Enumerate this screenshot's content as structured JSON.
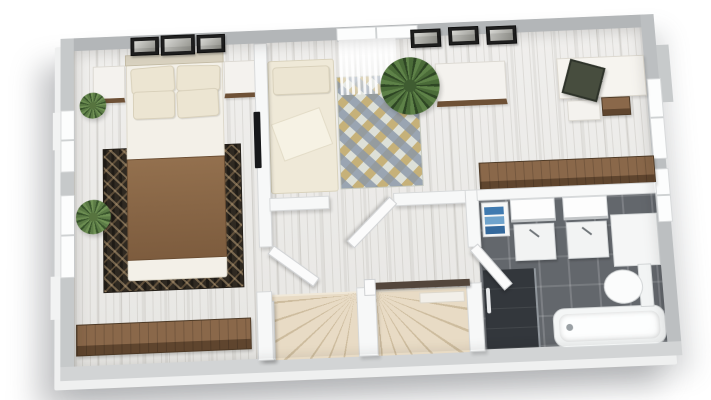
{
  "scene": {
    "view": "3d-floor-plan-render",
    "background": "#ffffff",
    "floor_style": "whitewashed-wood-planks",
    "bathroom_floor_style": "dark-gray-tile"
  },
  "palette": {
    "exterior_wall_cut": "#b6b9bb",
    "exterior_wall_light": "#d2d4d5",
    "interior_wall": "#f7f8f8",
    "wood_floor": "#edecea",
    "tile_floor": "#63676c",
    "shower_tile": "#33373c",
    "stair_tread": "#e8dbc5",
    "handrail": "#53463c",
    "rug_dark_base": "#2f2921",
    "rug_dark_accent": "#c4a880",
    "rug_diamond_base": "#dde0d8",
    "rug_diamond_blue": "#8996a8",
    "rug_diamond_gold": "#ba9846",
    "blanket_brown": "#8a6748",
    "bedding_cream": "#ece5d2",
    "furniture_wood": "#7a5c3e",
    "plant_green": "#567a44",
    "towel_blue": "#3f7ab0",
    "chair_olive": "#474d3e",
    "fixtures_white": "#f4f6f6"
  },
  "rooms": [
    {
      "name": "master-bedroom",
      "items": [
        "double-bed",
        "four-pillows",
        "brown-blanket",
        "nightstand-left",
        "nightstand-right",
        "wall-art-triptych",
        "dark-patterned-area-rug",
        "wall-mounted-tv",
        "potted-plant-corner",
        "potted-plant-window",
        "low-wood-sideboard",
        "window-left-upper",
        "window-left-lower"
      ]
    },
    {
      "name": "second-bedroom",
      "items": [
        "single-bed",
        "diamond-pattern-rug",
        "window-with-sheer-curtain",
        "fern-plant",
        "dresser",
        "wall-art-set-of-three",
        "corner-desk",
        "desk-chair",
        "printer-unit",
        "drawer-unit",
        "long-wood-counter",
        "window-right-wall"
      ]
    },
    {
      "name": "landing-hallway",
      "items": [
        "winder-staircase-left-flight",
        "winder-staircase-right-flight",
        "stair-divider-wall",
        "handrail",
        "door-to-master-bedroom",
        "door-to-second-bedroom",
        "door-to-bathroom"
      ]
    },
    {
      "name": "bathroom",
      "items": [
        "vanity-sink-left",
        "vanity-sink-right",
        "mirror-left",
        "mirror-right",
        "towel-shelf-blue-towels",
        "tall-cabinet",
        "toilet",
        "bathtub",
        "walk-in-shower"
      ]
    }
  ]
}
